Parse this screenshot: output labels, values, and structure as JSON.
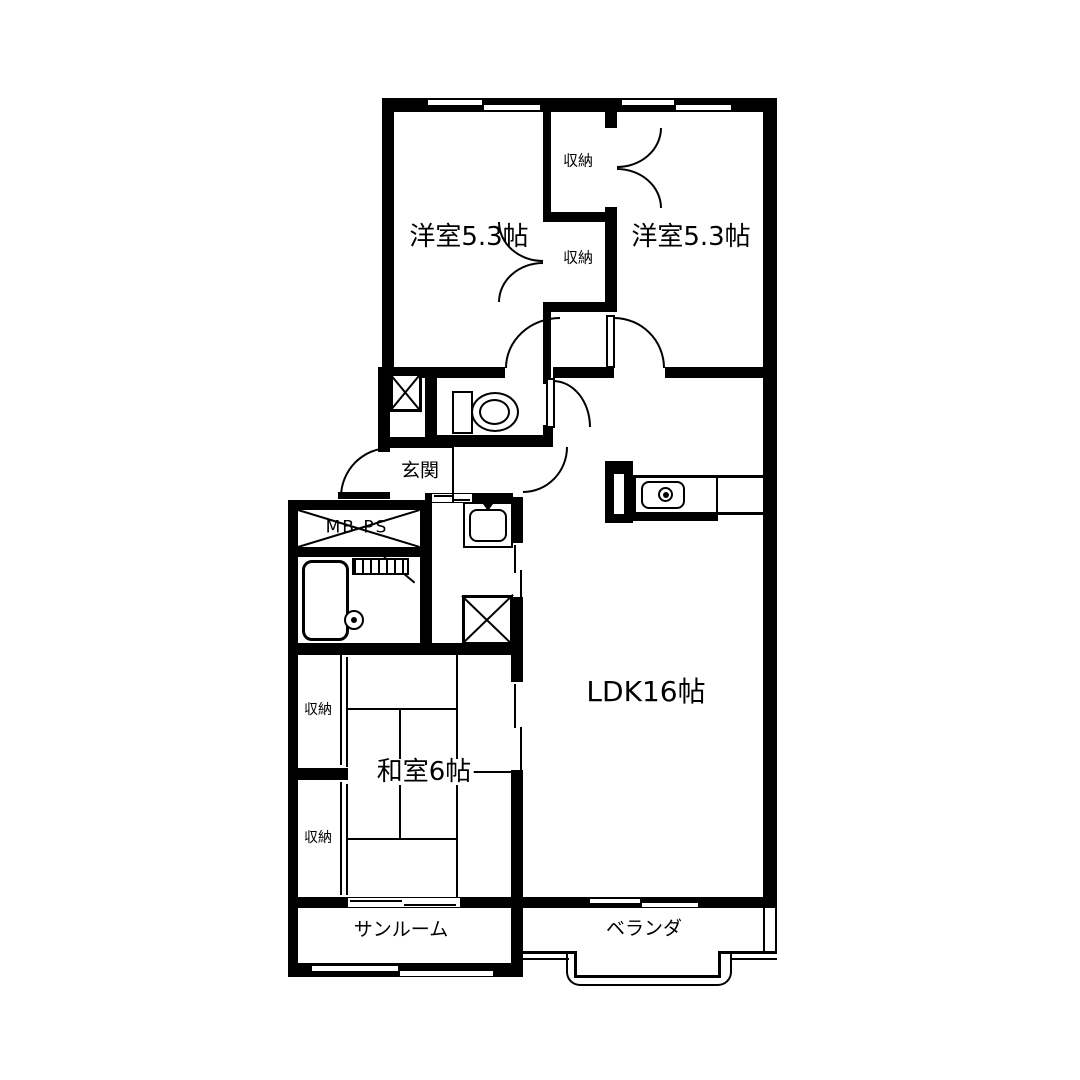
{
  "plan": {
    "colors": {
      "line": "#000000",
      "background": "#ffffff"
    },
    "rooms": {
      "bedroom1": {
        "label": "洋室5.3帖"
      },
      "bedroom2": {
        "label": "洋室5.3帖"
      },
      "closet_top": {
        "label": "収納"
      },
      "closet_mid": {
        "label": "収納"
      },
      "closet_left_top": {
        "label": "収納"
      },
      "closet_left_bottom": {
        "label": "収納"
      },
      "entrance": {
        "label": "玄関"
      },
      "meter_pipe_space": {
        "label": "MB PS"
      },
      "ldk": {
        "label": "LDK16帖"
      },
      "japanese_room": {
        "label": "和室6帖"
      },
      "sunroom": {
        "label": "サンルーム"
      },
      "veranda": {
        "label": "ベランダ"
      }
    },
    "icons": [
      "toilet-icon",
      "bathtub-icon",
      "washbasin-icon",
      "washing-machine-icon",
      "kitchen-sink-icon",
      "meter-box-cross-icon",
      "shaft-cross-icon",
      "door-swing-arc",
      "sliding-door",
      "window"
    ]
  }
}
